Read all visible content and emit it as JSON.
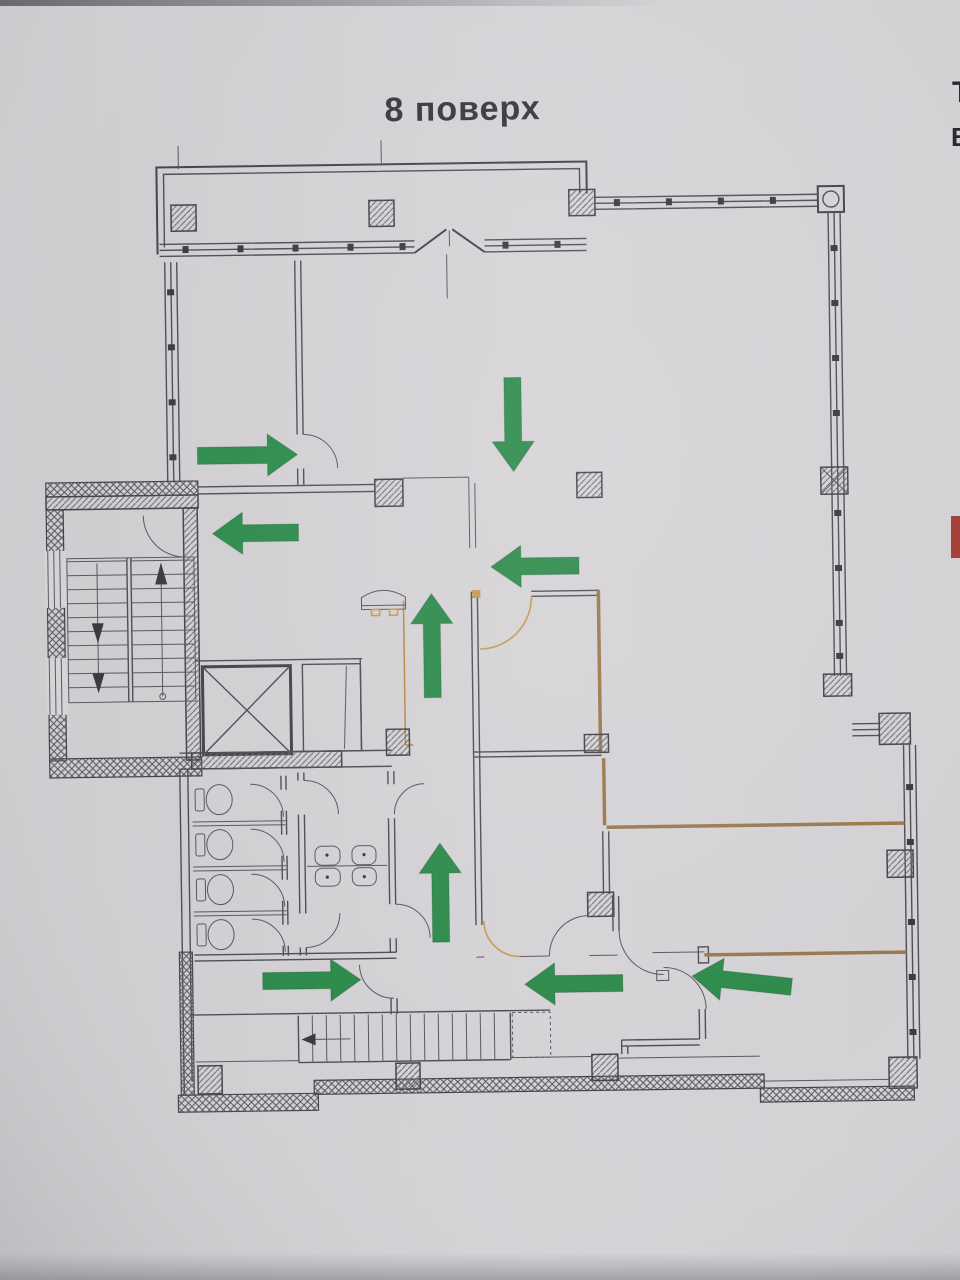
{
  "floor_plan": {
    "title": "8 поверх",
    "arrows": [
      {
        "name": "arrow-topleft-room-exit",
        "cx": 250,
        "cy": 452,
        "angle": 0,
        "len": 100
      },
      {
        "name": "arrow-hall-down",
        "cx": 516,
        "cy": 425,
        "angle": 90,
        "len": 94
      },
      {
        "name": "arrow-to-stairwell",
        "cx": 257,
        "cy": 530,
        "angle": 180,
        "len": 86
      },
      {
        "name": "arrow-hall-to-corridor",
        "cx": 536,
        "cy": 567,
        "angle": 180,
        "len": 88
      },
      {
        "name": "arrow-corridor-up-1",
        "cx": 432,
        "cy": 645,
        "angle": 270,
        "len": 104
      },
      {
        "name": "arrow-corridor-up-2",
        "cx": 437,
        "cy": 892,
        "angle": 270,
        "len": 99
      },
      {
        "name": "arrow-to-lower-stairs",
        "cx": 307,
        "cy": 978,
        "angle": 0,
        "len": 98
      },
      {
        "name": "arrow-lower-corridor-left",
        "cx": 569,
        "cy": 985,
        "angle": 180,
        "len": 98
      },
      {
        "name": "arrow-right-room-exit",
        "cx": 737,
        "cy": 985,
        "angle": 187,
        "len": 100
      }
    ],
    "colors": {
      "arrow": "#2e8b4c",
      "wall": "#45444a",
      "tan_wall": "#9a7950",
      "door": "#c49a4f",
      "red_marker": "#a33d35",
      "paper": "#d2d0d3"
    },
    "edge_fragments": [
      "Т",
      "В"
    ]
  }
}
